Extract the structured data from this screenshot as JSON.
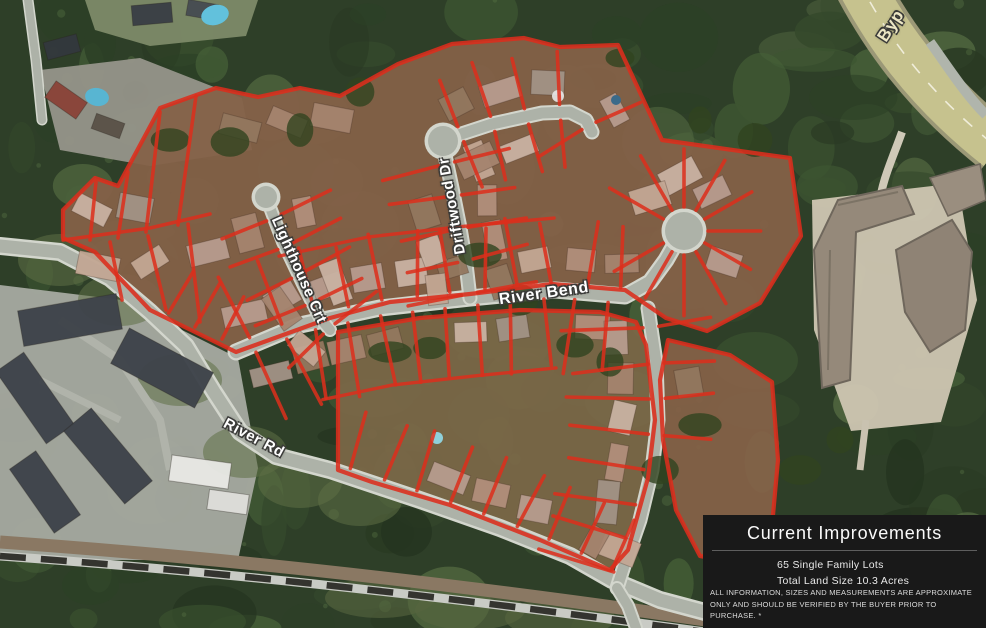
{
  "map": {
    "street_labels": [
      {
        "id": "driftwood-dr",
        "text": "Driftwood Dr"
      },
      {
        "id": "lighthouse-crt",
        "text": "Lighthouse Crt"
      },
      {
        "id": "river-bend",
        "text": "River Bend"
      },
      {
        "id": "river-rd",
        "text": "River Rd"
      },
      {
        "id": "bypass",
        "text": "Byp"
      }
    ]
  },
  "info_panel": {
    "title": "Current Improvements",
    "details": [
      "65 Single Family Lots",
      "Total Land Size 10.3 Acres"
    ],
    "disclaimer": "ALL INFORMATION, SIZES AND MEASUREMENTS ARE APPROXIMATE ONLY AND SHOULD BE VERIFIED BY THE BUYER PRIOR TO PURCHASE. *"
  },
  "colors": {
    "lot_line_red": "#dc2e1c",
    "road_gray": "#adb2a8",
    "road_casing": "#d3d6cd",
    "forest_green": "#2e3f28",
    "highway_tan": "#c6c28e",
    "panel_background": "#191919",
    "panel_text": "#f5f5f5",
    "label_white": "#ffffff",
    "bypass_label_cream": "#ece6c4"
  }
}
